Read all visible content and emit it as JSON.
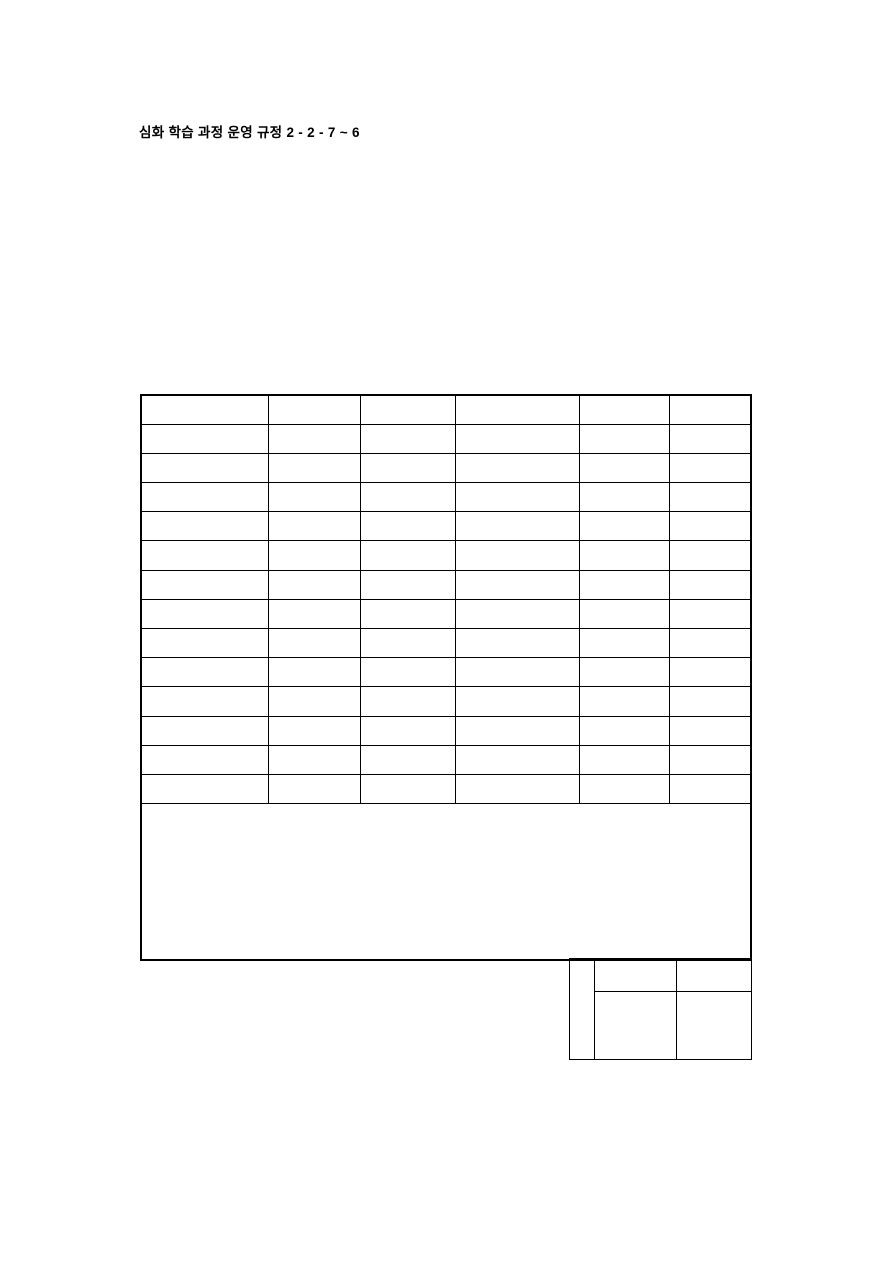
{
  "page": {
    "background_color": "#ffffff",
    "border_color": "#000000",
    "text_color": "#000000"
  },
  "header": {
    "full_text": "심화 학습 과정 운영 규정 2 - 2 - 7 ~ 6",
    "title": "심화 학습 과정 운영 규정",
    "code": "2 - 2 - 7 ~ 6"
  },
  "main_table": {
    "row_count": 14,
    "column_count": 6,
    "all_cells_empty": true,
    "merged_bottom_cell_empty": true
  },
  "approval_box": {
    "row_count": 2,
    "column_count": 3,
    "all_cells_empty": true
  }
}
